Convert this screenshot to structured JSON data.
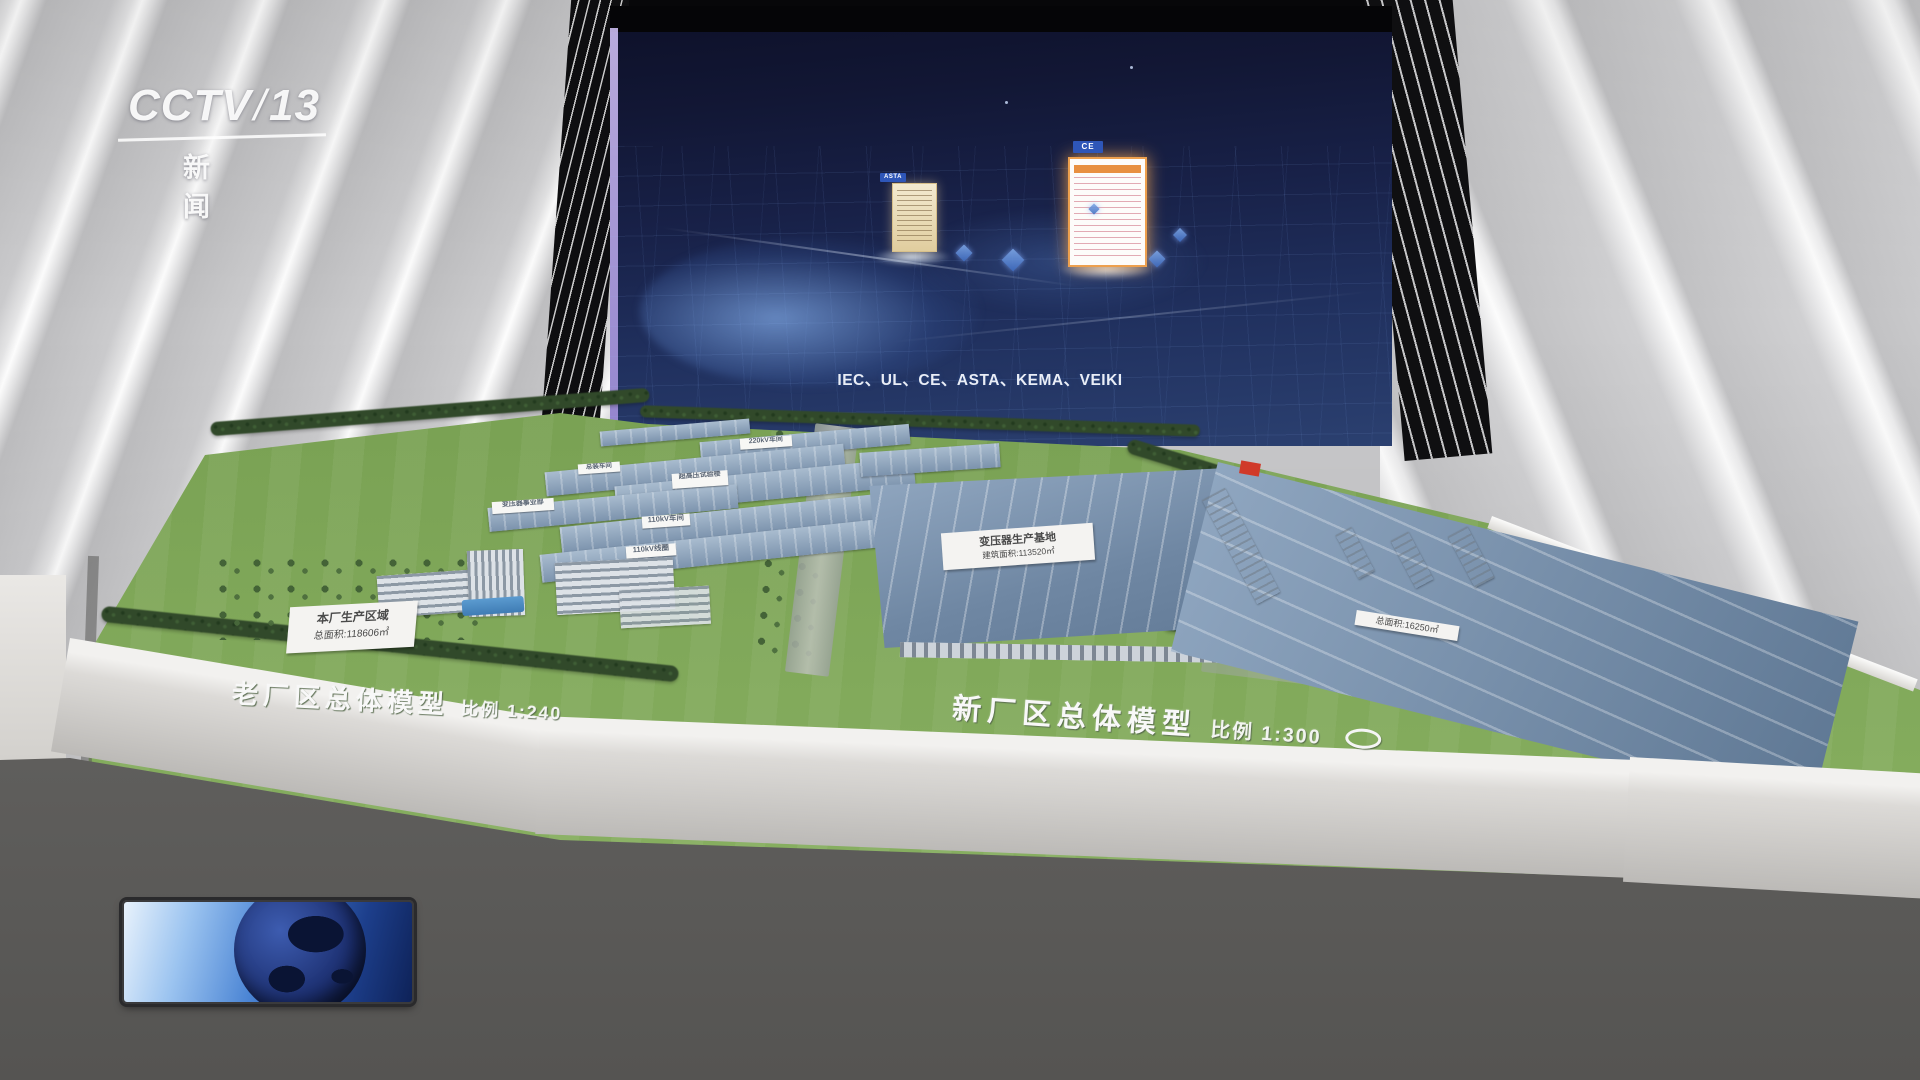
{
  "channel_bug": {
    "name": "CCTV",
    "slash": "/",
    "number": "13",
    "subtitle": "新 闻"
  },
  "screen": {
    "caption": "IEC、UL、CE、ASTA、KEMA、VEIKI",
    "cert_left_tag": "ASTA",
    "cert_right_tag": "CE"
  },
  "model": {
    "old_zone": {
      "ground_label": "老厂区总体模型",
      "ground_scale": "比例 1:240",
      "area_sign_line1": "本厂生产区域",
      "area_sign_line2": "总面积:118606㎡",
      "roof_labels": [
        "220kV车间",
        "总装车间",
        "超高压试验楼",
        "变压器事业部",
        "110kV车间",
        "110kV线圈"
      ]
    },
    "center_zone": {
      "roof_sign_line1": "变压器生产基地",
      "roof_sign_line2": "建筑面积:113520㎡"
    },
    "new_zone": {
      "ground_label": "新厂区总体模型",
      "ground_scale": "比例 1:300",
      "roof_sign": "总面积:16250㎡"
    }
  },
  "colors": {
    "screen_navy": "#1a2450",
    "wall_gray": "#c8c8ca",
    "grass_green": "#76a050",
    "roof_blue": "#7c93ad",
    "accent_orange": "#f0a53c",
    "cert_tag_blue": "#2e56b8"
  }
}
